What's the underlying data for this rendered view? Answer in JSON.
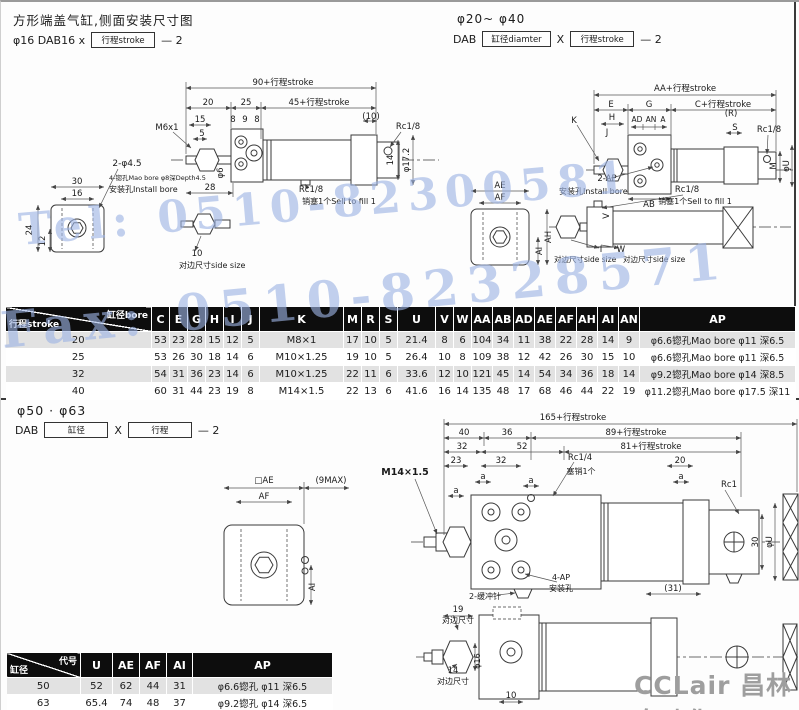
{
  "page": {
    "watermark_tel": "Tel: 0510-82300581",
    "watermark_fax": "Fax: 0510-82328571",
    "logo": "CCLair 昌林自动化"
  },
  "section1": {
    "title": "方形端盖气缸,侧面安装尺寸图",
    "left_model": {
      "prefix": "φ16  DAB16 x",
      "box": "行程stroke",
      "suffix": "— 2"
    },
    "right_range": "φ20~ φ40",
    "right_model": {
      "prefix": "DAB",
      "box1": "缸径diamter",
      "x": "X",
      "box2": "行程stroke",
      "suffix": "— 2"
    },
    "drawingA": {
      "labels": [
        {
          "t": "90+行程stroke",
          "x": 262,
          "y": 23
        },
        {
          "t": "20",
          "x": 187,
          "y": 43
        },
        {
          "t": "25",
          "x": 225,
          "y": 43
        },
        {
          "t": "45+行程stroke",
          "x": 298,
          "y": 43
        },
        {
          "t": "(10)",
          "x": 350,
          "y": 57
        },
        {
          "t": "15",
          "x": 179,
          "y": 60
        },
        {
          "t": "5",
          "x": 181,
          "y": 74
        },
        {
          "t": "M6x1",
          "x": 146,
          "y": 68
        },
        {
          "t": "8",
          "x": 212,
          "y": 60
        },
        {
          "t": "9",
          "x": 224,
          "y": 60
        },
        {
          "t": "8",
          "x": 236,
          "y": 60
        },
        {
          "t": "Rc1/8",
          "x": 387,
          "y": 67
        },
        {
          "t": "14",
          "x": 372,
          "y": 98,
          "r": -90
        },
        {
          "t": "φ17.2",
          "x": 388,
          "y": 98,
          "r": -90
        },
        {
          "t": "φ6",
          "x": 202,
          "y": 111,
          "r": -90
        },
        {
          "t": "28",
          "x": 189,
          "y": 128
        },
        {
          "t": "Rc1/8",
          "x": 290,
          "y": 130
        },
        {
          "t": "销塞1个Sell to fill 1",
          "x": 318,
          "y": 142,
          "fs": 8
        },
        {
          "t": "2-φ4.5",
          "x": 106,
          "y": 104,
          "fs": 9
        },
        {
          "t": "4-锪孔Mao bore φ8深Depth4.5",
          "x": 88,
          "y": 118,
          "a": "start",
          "fs": 6.5
        },
        {
          "t": "安装孔Install bore",
          "x": 88,
          "y": 130,
          "a": "start",
          "fs": 8
        },
        {
          "t": "30",
          "x": 56,
          "y": 122
        },
        {
          "t": "16",
          "x": 56,
          "y": 134
        },
        {
          "t": "24",
          "x": 11,
          "y": 168,
          "r": -90
        },
        {
          "t": "12",
          "x": 24,
          "y": 179,
          "r": -90
        },
        {
          "t": "10",
          "x": 176,
          "y": 194
        },
        {
          "t": "对边尺寸side size",
          "x": 158,
          "y": 206,
          "a": "start",
          "fs": 8
        }
      ]
    },
    "drawingB": {
      "labels": [
        {
          "t": "AA+行程stroke",
          "x": 224,
          "y": 14
        },
        {
          "t": "E",
          "x": 150,
          "y": 30
        },
        {
          "t": "G",
          "x": 188,
          "y": 30
        },
        {
          "t": "C+行程stroke",
          "x": 262,
          "y": 30
        },
        {
          "t": "K",
          "x": 113,
          "y": 46
        },
        {
          "t": "H",
          "x": 151,
          "y": 43
        },
        {
          "t": "J",
          "x": 146,
          "y": 58
        },
        {
          "t": "AD",
          "x": 176,
          "y": 45,
          "fs": 7.5
        },
        {
          "t": "AN",
          "x": 190,
          "y": 45,
          "fs": 7.5
        },
        {
          "t": "A",
          "x": 202,
          "y": 45,
          "fs": 7.5
        },
        {
          "t": "(R)",
          "x": 270,
          "y": 39
        },
        {
          "t": "S",
          "x": 274,
          "y": 53
        },
        {
          "t": "Rc1/8",
          "x": 308,
          "y": 55
        },
        {
          "t": "M",
          "x": 315,
          "y": 89,
          "r": -90
        },
        {
          "t": "φU",
          "x": 328,
          "y": 89,
          "r": -90
        },
        {
          "t": "2-AP",
          "x": 146,
          "y": 104
        },
        {
          "t": "安装孔Install bore",
          "x": 98,
          "y": 117,
          "a": "start",
          "fs": 8
        },
        {
          "t": "AB",
          "x": 188,
          "y": 130
        },
        {
          "t": "Rc1/8",
          "x": 226,
          "y": 115
        },
        {
          "t": "销塞1个Sell to fill 1",
          "x": 234,
          "y": 127,
          "fs": 8
        },
        {
          "t": "AE",
          "x": 39,
          "y": 111
        },
        {
          "t": "AF",
          "x": 39,
          "y": 123
        },
        {
          "t": "AH",
          "x": 90,
          "y": 160,
          "r": -90
        },
        {
          "t": "AI",
          "x": 81,
          "y": 174,
          "r": -90
        },
        {
          "t": "V",
          "x": 148,
          "y": 139,
          "r": -90
        },
        {
          "t": "I",
          "x": 140,
          "y": 175
        },
        {
          "t": "W",
          "x": 160,
          "y": 175
        },
        {
          "t": "对边尺寸side size",
          "x": 93,
          "y": 185,
          "a": "start",
          "fs": 7.5
        },
        {
          "t": "对边尺寸side size",
          "x": 162,
          "y": 185,
          "a": "start",
          "fs": 7.5
        }
      ]
    }
  },
  "table1": {
    "corner": {
      "top": "缸径bore",
      "bottom": "行程stroke"
    },
    "columns": [
      "C",
      "E",
      "G",
      "H",
      "I",
      "J",
      "K",
      "M",
      "R",
      "S",
      "U",
      "V",
      "W",
      "AA",
      "AB",
      "AD",
      "AE",
      "AF",
      "AH",
      "AI",
      "AN",
      "AP"
    ],
    "widths": [
      146,
      18,
      18,
      18,
      18,
      18,
      18,
      84,
      18,
      18,
      18,
      38,
      18,
      18,
      21,
      21,
      21,
      21,
      21,
      21,
      21,
      21,
      156
    ],
    "rows": [
      {
        "label": "20",
        "values": [
          "53",
          "23",
          "28",
          "15",
          "12",
          "5",
          "M8×1",
          "17",
          "10",
          "5",
          "21.4",
          "8",
          "6",
          "104",
          "34",
          "11",
          "38",
          "22",
          "28",
          "14",
          "9",
          "φ6.6锪孔Mao bore  φ11  深6.5"
        ]
      },
      {
        "label": "25",
        "values": [
          "53",
          "26",
          "30",
          "18",
          "14",
          "6",
          "M10×1.25",
          "19",
          "10",
          "5",
          "26.4",
          "10",
          "8",
          "109",
          "38",
          "12",
          "42",
          "26",
          "30",
          "15",
          "10",
          "φ6.6锪孔Mao bore  φ11  深6.5"
        ]
      },
      {
        "label": "32",
        "values": [
          "54",
          "31",
          "36",
          "23",
          "14",
          "6",
          "M10×1.25",
          "22",
          "11",
          "6",
          "33.6",
          "12",
          "10",
          "121",
          "45",
          "14",
          "54",
          "34",
          "36",
          "18",
          "14",
          "φ9.2锪孔Mao bore  φ14  深8.5"
        ]
      },
      {
        "label": "40",
        "values": [
          "60",
          "31",
          "44",
          "23",
          "19",
          "8",
          "M14×1.5",
          "22",
          "13",
          "6",
          "41.6",
          "16",
          "14",
          "135",
          "48",
          "17",
          "68",
          "46",
          "44",
          "22",
          "19",
          "φ11.2锪孔Mao bore  φ17.5  深11"
        ]
      }
    ]
  },
  "section2": {
    "range": "φ50 · φ63",
    "model": {
      "prefix": "DAB",
      "box1": "缸径",
      "x": "X",
      "box2": "行程",
      "suffix": "— 2"
    },
    "drawingC": {
      "labels": [
        {
          "t": "165+行程stroke",
          "x": 392,
          "y": 18
        },
        {
          "t": "40",
          "x": 283,
          "y": 33
        },
        {
          "t": "36",
          "x": 326,
          "y": 33
        },
        {
          "t": "89+行程stroke",
          "x": 455,
          "y": 33
        },
        {
          "t": "32",
          "x": 281,
          "y": 47
        },
        {
          "t": "52",
          "x": 341,
          "y": 47
        },
        {
          "t": "81+行程stroke",
          "x": 470,
          "y": 47
        },
        {
          "t": "23",
          "x": 275,
          "y": 61
        },
        {
          "t": "32",
          "x": 320,
          "y": 61
        },
        {
          "t": "Rc1/4",
          "x": 399,
          "y": 58
        },
        {
          "t": "塞销1个",
          "x": 400,
          "y": 72,
          "fs": 8
        },
        {
          "t": "20",
          "x": 499,
          "y": 61
        },
        {
          "t": "a",
          "x": 302,
          "y": 77
        },
        {
          "t": "a",
          "x": 350,
          "y": 81
        },
        {
          "t": "a",
          "x": 500,
          "y": 77
        },
        {
          "t": "a",
          "x": 275,
          "y": 91
        },
        {
          "t": "M14×1.5",
          "x": 224,
          "y": 73,
          "b": 1,
          "fs": 9.5
        },
        {
          "t": "Rc1",
          "x": 548,
          "y": 85
        },
        {
          "t": "30",
          "x": 577,
          "y": 140,
          "r": -90
        },
        {
          "t": "φU",
          "x": 591,
          "y": 140,
          "r": -90
        },
        {
          "t": "(31)",
          "x": 492,
          "y": 189
        },
        {
          "t": "2-缓冲针",
          "x": 304,
          "y": 197,
          "fs": 8
        },
        {
          "t": "4-AP",
          "x": 380,
          "y": 178,
          "fs": 8
        },
        {
          "t": "安装孔",
          "x": 380,
          "y": 189,
          "fs": 8
        },
        {
          "t": "□AE",
          "x": 83,
          "y": 81
        },
        {
          "t": "AF",
          "x": 83,
          "y": 97
        },
        {
          "t": "(9MAX)",
          "x": 150,
          "y": 81
        },
        {
          "t": "AI",
          "x": 134,
          "y": 185,
          "r": -90
        },
        {
          "t": "19",
          "x": 277,
          "y": 210
        },
        {
          "t": "对边尺寸",
          "x": 277,
          "y": 221,
          "fs": 8
        },
        {
          "t": "14",
          "x": 272,
          "y": 271
        },
        {
          "t": "对边尺寸",
          "x": 272,
          "y": 282,
          "fs": 8
        },
        {
          "t": "φ16",
          "x": 299,
          "y": 259,
          "r": -90,
          "fs": 8
        },
        {
          "t": "10",
          "x": 330,
          "y": 296
        }
      ]
    }
  },
  "table2": {
    "corner": {
      "top": "代号",
      "bottom": "缸径"
    },
    "columns": [
      "U",
      "AE",
      "AF",
      "AI",
      "AP"
    ],
    "widths": [
      74,
      32,
      27,
      27,
      26,
      140
    ],
    "rows": [
      {
        "label": "50",
        "values": [
          "52",
          "62",
          "44",
          "31",
          "φ6.6锪孔  φ11  深6.5"
        ]
      },
      {
        "label": "63",
        "values": [
          "65.4",
          "74",
          "48",
          "37",
          "φ9.2锪孔  φ14  深6.5"
        ]
      }
    ]
  }
}
